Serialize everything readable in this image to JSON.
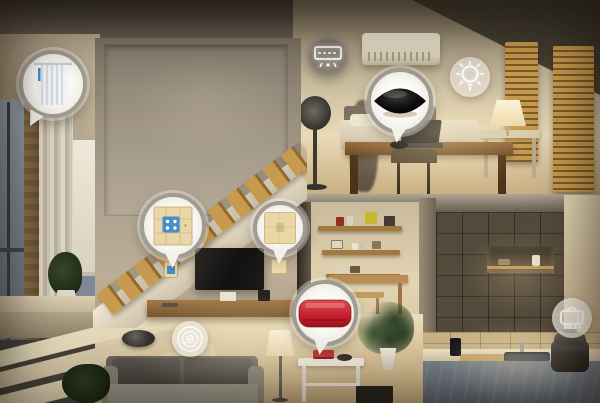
{
  "meta": {
    "content_type": "smart-home-concept-render",
    "time_of_day": "evening",
    "width": 600,
    "height": 403
  },
  "palette": {
    "ring": "#a09c93",
    "bubble_fill": "#fdfcf9",
    "device_red": "#c8242f",
    "switch_blue": "#4a8cc8",
    "plate_beige": "#ead7a8",
    "wood_amber": "#c79a4d"
  },
  "callouts": [
    {
      "id": "curtain",
      "icon": "curtain",
      "style": "solid",
      "cx": 53,
      "cy": 84,
      "r": 34,
      "tail": {
        "left": 6,
        "rotate": 28
      }
    },
    {
      "id": "ac-remote",
      "icon": "ac-remote",
      "style": "glass",
      "tint": "rgba(112,106,96,0.68)",
      "cx": 328,
      "cy": 57,
      "r": 21
    },
    {
      "id": "ir-hub",
      "icon": "ir-hub",
      "style": "solid",
      "cx": 400,
      "cy": 101,
      "r": 33,
      "tail": {
        "left": 22,
        "rotate": 8
      }
    },
    {
      "id": "light",
      "icon": "bulb",
      "style": "glass",
      "tint": "rgba(228,222,210,0.72)",
      "cx": 470,
      "cy": 77,
      "r": 20
    },
    {
      "id": "wall-switch",
      "icon": "switch-panel",
      "style": "solid",
      "cx": 173,
      "cy": 226,
      "r": 33,
      "tail": {
        "left": 24,
        "rotate": 0
      }
    },
    {
      "id": "scene-panel",
      "icon": "blank-panel",
      "style": "solid",
      "cx": 280,
      "cy": 228,
      "r": 27,
      "tail": {
        "left": 18,
        "rotate": 5
      }
    },
    {
      "id": "power-device",
      "icon": "red-device",
      "style": "solid",
      "cx": 325,
      "cy": 313,
      "r": 33,
      "tail": {
        "left": 20,
        "rotate": 8
      }
    },
    {
      "id": "robot-vacuum",
      "icon": "vacuum",
      "style": "glass",
      "tint": "rgba(244,239,229,0.6)",
      "cx": 190,
      "cy": 339,
      "r": 18
    },
    {
      "id": "rice-cooker",
      "icon": "cooker",
      "style": "glass",
      "tint": "rgba(247,243,235,0.65)",
      "cx": 572,
      "cy": 318,
      "r": 20
    }
  ],
  "scene_objects": [
    "air-conditioner",
    "standing-fan",
    "office-desk",
    "laptop",
    "office-chair",
    "bed-bench",
    "table-lamp",
    "wood-slat-panels",
    "staircase",
    "tv",
    "media-shelf",
    "wall-switch",
    "wall-plate",
    "window",
    "curtain",
    "roller-shade",
    "sofa",
    "floor-lamp",
    "console-table",
    "red-mini-device",
    "robot-vacuum",
    "potted-plants",
    "wall-shelves",
    "shower-niche",
    "kitchen-counter",
    "sink",
    "cutting-board",
    "rice-cooker"
  ]
}
